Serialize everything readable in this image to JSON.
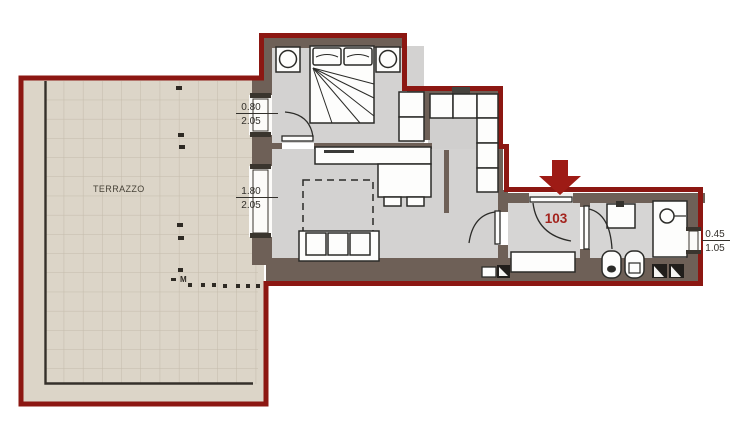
{
  "plan_title": "Apartment floor plan",
  "terrace": {
    "label": "TERRAZZO",
    "marker_letter": "M"
  },
  "unit": {
    "number": "103"
  },
  "dimensions": [
    {
      "width_m": "0.80",
      "height_m": "2.05"
    },
    {
      "width_m": "1.80",
      "height_m": "2.05"
    },
    {
      "width_m": "0.45",
      "height_m": "1.05"
    }
  ],
  "colors": {
    "outline_red": "#8C1712",
    "accent_red": "#A3231D",
    "arrow_red": "#9E1B15",
    "wall_brown": "#6E6057",
    "floor_gray": "#D3D2D1",
    "terrace_beige": "#DCD5C8",
    "tile_line": "#C4BBAB",
    "line_dark": "#2B2B28"
  }
}
